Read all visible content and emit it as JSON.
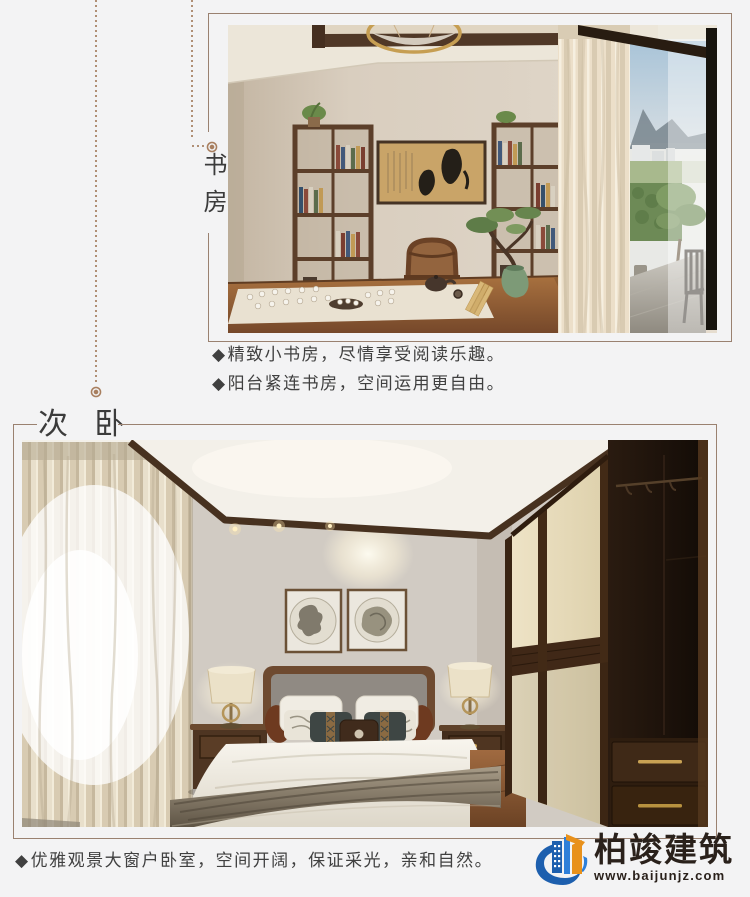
{
  "page": {
    "background": "#f3f3f4"
  },
  "decor": {
    "frame_line_color": "#9a8170",
    "dotted_line_color": "#b08f75"
  },
  "sections": {
    "study": {
      "title": "书房",
      "bullets": [
        {
          "marker": "◆",
          "text": "精致小书房，尽情享受阅读乐趣。"
        },
        {
          "marker": "◆",
          "text": "阳台紧连书房，空间运用更自由。"
        }
      ],
      "photo": "study-room-interior"
    },
    "bedroom": {
      "title": "次 卧",
      "bullets": [
        {
          "marker": "◆",
          "text": "优雅观景大窗户卧室，空间开阔，保证采光，亲和自然。"
        }
      ],
      "photo": "secondary-bedroom-interior"
    }
  },
  "logo": {
    "name": "柏竣建筑",
    "website": "www.baijunjz.com",
    "blue": "#1d5fae",
    "orange": "#e8911c"
  }
}
